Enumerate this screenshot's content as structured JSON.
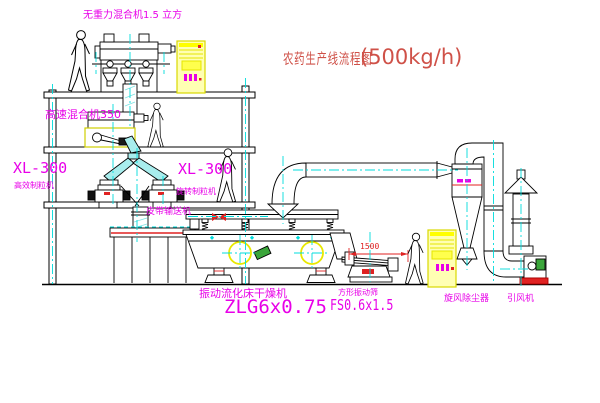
{
  "title": {
    "main": "农药生产线流程图",
    "capacity": "(500kg/h)"
  },
  "labels": {
    "gravity_mixer": "无重力混合机1.5 立方",
    "high_speed_mixer": "高速混合机350",
    "granulator_left_model": "XL-300",
    "granulator_left_name": "高效制粒机",
    "granulator_right_model": "XL-300",
    "granulator_right_name": "旋转制粒机",
    "belt_conveyor": "皮带输送机",
    "dryer_name": "振动流化床干燥机",
    "dryer_model": "ZLG6x0.75",
    "sieve_name": "方形振动筛",
    "sieve_model": "FS0.6x1.5",
    "cyclone": "旋风除尘器",
    "induced_draft_fan": "引风机",
    "sieve_dimension": "1500"
  },
  "colors": {
    "label_magenta": "#e800e8",
    "title_red": "#cf5148",
    "accent_red": "#e02222",
    "centerline_cyan": "#00dcdc",
    "cabinet_yellow": "#ffff00",
    "machine_green": "#3aa53a",
    "line_black": "#000000"
  }
}
